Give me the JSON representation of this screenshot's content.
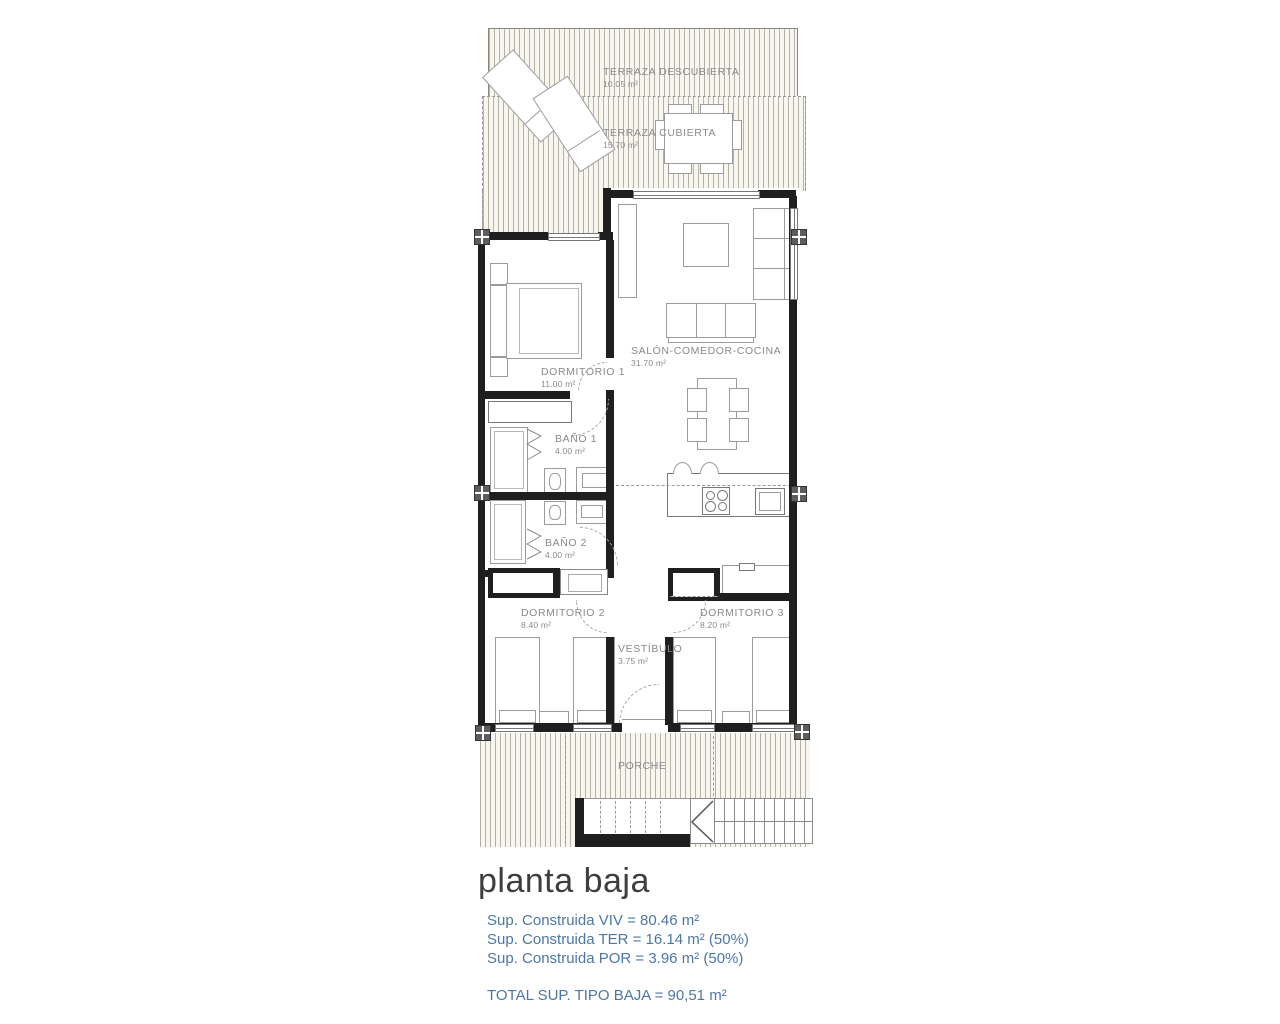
{
  "plan": {
    "rooms": [
      {
        "name": "TERRAZA DESCUBIERTA",
        "area": "10.05 m²"
      },
      {
        "name": "TERRAZA CUBIERTA",
        "area": "15.70 m²"
      },
      {
        "name": "SALÓN-COMEDOR-COCINA",
        "area": "31.70 m²"
      },
      {
        "name": "DORMITORIO 1",
        "area": "11.00 m²"
      },
      {
        "name": "BAÑO 1",
        "area": "4.00 m²"
      },
      {
        "name": "BAÑO 2",
        "area": "4.00 m²"
      },
      {
        "name": "DORMITORIO 2",
        "area": "8.40 m²"
      },
      {
        "name": "DORMITORIO 3",
        "area": "8.20 m²"
      },
      {
        "name": "VESTÍBULO",
        "area": "3.75 m²"
      },
      {
        "name": "PORCHE",
        "area": ""
      }
    ],
    "colors": {
      "wall": "#1f1f1f",
      "hatch_line": "#b7b3a4",
      "label_gray": "#8a8a8a"
    }
  },
  "footer": {
    "title": "planta baja",
    "summary_lines": [
      "Sup. Construida VIV = 80.46 m²",
      "Sup. Construida TER = 16.14 m² (50%)",
      "Sup. Construida POR = 3.96 m² (50%)"
    ],
    "total_line": "TOTAL SUP. TIPO BAJA = 90,51 m²",
    "text_color": "#4c77a4",
    "title_color": "#3e3e3e"
  }
}
